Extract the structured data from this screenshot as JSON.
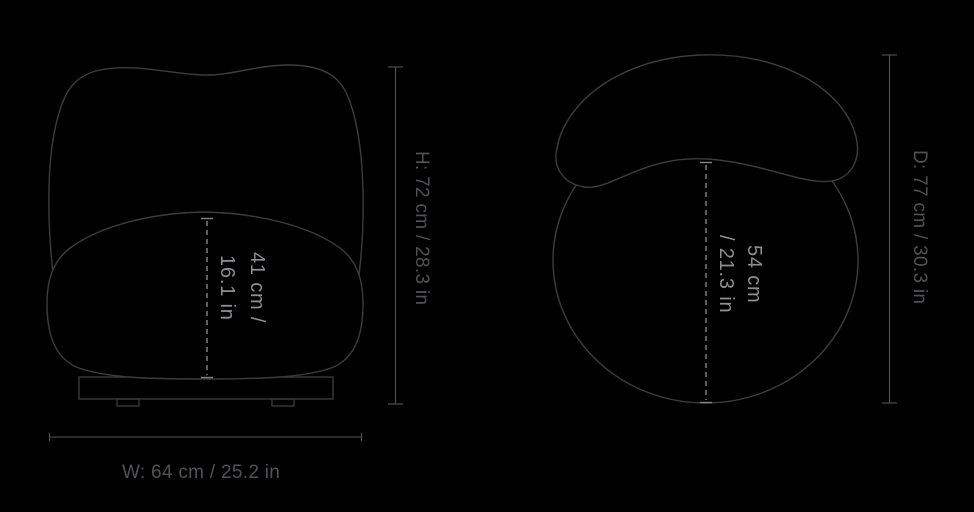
{
  "colors": {
    "background": "#000000",
    "chair_outline": "#3c3d3f",
    "dimension_line": "#525356",
    "dashed_line": "#85868a",
    "outer_label_text": "#515256",
    "inner_label_text": "#8e8f94"
  },
  "front_view": {
    "seat_height": {
      "line1": "41 cm /",
      "line2": "16.1 in"
    },
    "height_label": "H: 72 cm / 28.3 in",
    "width_label": "W: 64 cm / 25.2 in"
  },
  "top_view": {
    "seat_depth": {
      "line1": "54 cm",
      "line2": "/ 21.3 in"
    },
    "depth_label": "D: 77 cm / 30.3 in"
  }
}
